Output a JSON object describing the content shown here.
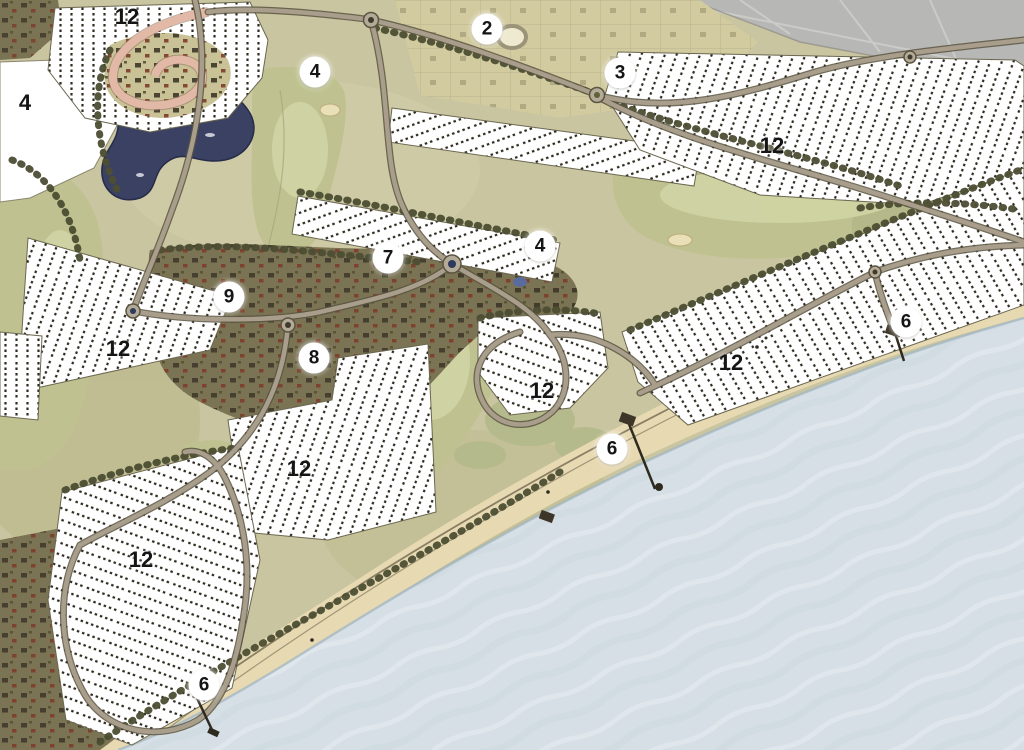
{
  "map": {
    "kind": "illustrated coastal resort master plan",
    "markers": [
      {
        "label": "12",
        "x": 127,
        "y": 17,
        "style": "plain"
      },
      {
        "label": "2",
        "x": 487,
        "y": 29,
        "style": "circle"
      },
      {
        "label": "4",
        "x": 315,
        "y": 72,
        "style": "circle"
      },
      {
        "label": "3",
        "x": 620,
        "y": 73,
        "style": "circle"
      },
      {
        "label": "4",
        "x": 25,
        "y": 103,
        "style": "plain"
      },
      {
        "label": "12",
        "x": 772,
        "y": 146,
        "style": "plain"
      },
      {
        "label": "4",
        "x": 540,
        "y": 246,
        "style": "circle"
      },
      {
        "label": "7",
        "x": 388,
        "y": 258,
        "style": "circle"
      },
      {
        "label": "9",
        "x": 229,
        "y": 297,
        "style": "circle"
      },
      {
        "label": "6",
        "x": 906,
        "y": 322,
        "style": "circle"
      },
      {
        "label": "12",
        "x": 118,
        "y": 349,
        "style": "plain"
      },
      {
        "label": "8",
        "x": 314,
        "y": 358,
        "style": "circle"
      },
      {
        "label": "12",
        "x": 731,
        "y": 363,
        "style": "plain"
      },
      {
        "label": "12",
        "x": 542,
        "y": 391,
        "style": "plain"
      },
      {
        "label": "6",
        "x": 612,
        "y": 449,
        "style": "circle"
      },
      {
        "label": "12",
        "x": 299,
        "y": 469,
        "style": "plain"
      },
      {
        "label": "12",
        "x": 141,
        "y": 560,
        "style": "plain"
      },
      {
        "label": "6",
        "x": 204,
        "y": 685,
        "style": "circle"
      }
    ]
  },
  "palette": {
    "land": "#c9c5a0",
    "land_light": "#d6d0ab",
    "fairway": "#bfc290",
    "fairway_light": "#d0d4a4",
    "bunker": "#e9e0b8",
    "tree_dark": "#4c4e33",
    "village": "#7a7354",
    "building_dark": "#3d3628",
    "building_red": "#7d3b28",
    "district": "#d2cba0",
    "road": "#a89e8b",
    "road_casing": "#5a5440",
    "loop_road": "#e2b9a6",
    "lake": "#3a4162",
    "sand": "#e7d9b2",
    "sand_edge": "#8a7f63",
    "water": "#d5dfe5",
    "water_texture": "#c3d0d9",
    "aerial": "#b7b7b5",
    "lots_white": "#ffffff",
    "lots_tick": "#2e2b20",
    "marker_bg": "#ffffff",
    "marker_text": "#151515"
  }
}
